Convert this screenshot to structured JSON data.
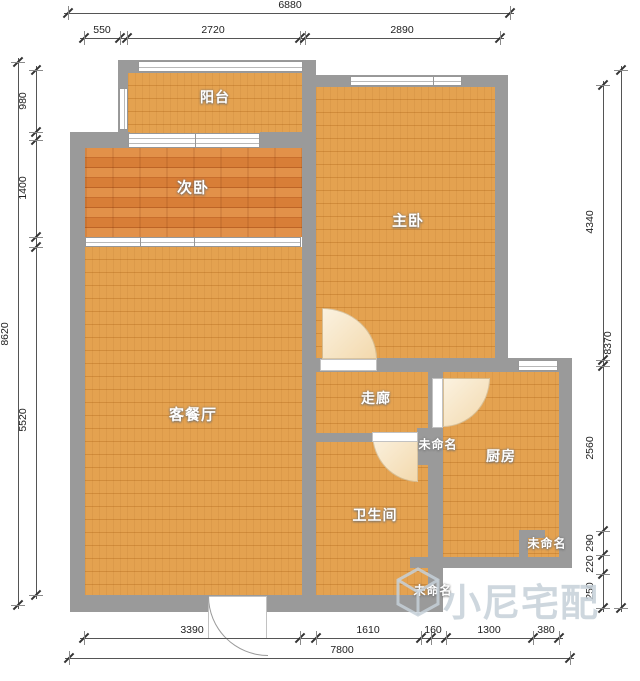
{
  "canvas": {
    "width": 640,
    "height": 681,
    "background": "#ffffff"
  },
  "colors": {
    "wall": "#9a9a9a",
    "floor_base": "#e4a250",
    "floor_seam": "#d18c3b",
    "floor_alt_base": "#d87e37",
    "floor_alt_dark": "#c86e2d",
    "window_fill": "#ffffff",
    "door_swing_fill": "#f6e3bf",
    "dimension_line": "#555555",
    "dimension_text": "#222222",
    "watermark": "#c6d0d8"
  },
  "watermark": {
    "text": "小尼宅配",
    "text_x": 443,
    "text_y": 572,
    "logo": {
      "name": "cube-logo",
      "x": 395,
      "y": 567,
      "w": 46,
      "h": 50
    }
  },
  "rooms": [
    {
      "label": "阳台",
      "x": 215,
      "y": 97,
      "size": 14
    },
    {
      "label": "次卧",
      "x": 193,
      "y": 187,
      "size": 15
    },
    {
      "label": "主卧",
      "x": 408,
      "y": 220,
      "size": 15
    },
    {
      "label": "客餐厅",
      "x": 193,
      "y": 414,
      "size": 15
    },
    {
      "label": "走廊",
      "x": 376,
      "y": 398,
      "size": 14
    },
    {
      "label": "未命名",
      "x": 438,
      "y": 444,
      "size": 12
    },
    {
      "label": "厨房",
      "x": 501,
      "y": 456,
      "size": 14
    },
    {
      "label": "卫生间",
      "x": 375,
      "y": 515,
      "size": 14
    },
    {
      "label": "未命名",
      "x": 547,
      "y": 543,
      "size": 12
    },
    {
      "label": "未命名",
      "x": 433,
      "y": 590,
      "size": 12
    }
  ],
  "plan": {
    "floors": [
      {
        "name": "balcony",
        "style": "floor",
        "x": 128,
        "y": 73,
        "w": 174,
        "h": 60
      },
      {
        "name": "bedroom2",
        "style": "floor-alt",
        "x": 85,
        "y": 148,
        "w": 217,
        "h": 89
      },
      {
        "name": "living",
        "style": "floor",
        "x": 85,
        "y": 247,
        "w": 217,
        "h": 348
      },
      {
        "name": "master",
        "style": "floor",
        "x": 316,
        "y": 87,
        "w": 179,
        "h": 271
      },
      {
        "name": "corridor",
        "style": "floor",
        "x": 316,
        "y": 372,
        "w": 112,
        "h": 61
      },
      {
        "name": "bathroom",
        "style": "floor",
        "x": 316,
        "y": 442,
        "w": 112,
        "h": 153
      },
      {
        "name": "kitchen",
        "style": "floor",
        "x": 443,
        "y": 372,
        "w": 117,
        "h": 185
      }
    ],
    "walls": [
      {
        "x": 118,
        "y": 60,
        "w": 190,
        "h": 13
      },
      {
        "x": 118,
        "y": 60,
        "w": 10,
        "h": 75
      },
      {
        "x": 70,
        "y": 132,
        "w": 60,
        "h": 16
      },
      {
        "x": 260,
        "y": 132,
        "w": 56,
        "h": 16
      },
      {
        "x": 70,
        "y": 132,
        "w": 15,
        "h": 480
      },
      {
        "x": 302,
        "y": 75,
        "w": 206,
        "h": 12
      },
      {
        "x": 302,
        "y": 60,
        "w": 14,
        "h": 552
      },
      {
        "x": 495,
        "y": 75,
        "w": 13,
        "h": 290
      },
      {
        "x": 302,
        "y": 358,
        "w": 270,
        "h": 14
      },
      {
        "x": 559,
        "y": 358,
        "w": 13,
        "h": 210
      },
      {
        "x": 302,
        "y": 433,
        "w": 70,
        "h": 9
      },
      {
        "x": 417,
        "y": 428,
        "w": 15,
        "h": 37
      },
      {
        "x": 428,
        "y": 372,
        "w": 15,
        "h": 196
      },
      {
        "x": 410,
        "y": 557,
        "w": 162,
        "h": 11
      },
      {
        "x": 428,
        "y": 557,
        "w": 15,
        "h": 55
      },
      {
        "x": 70,
        "y": 595,
        "w": 372,
        "h": 17
      },
      {
        "x": 519,
        "y": 530,
        "w": 9,
        "h": 30
      },
      {
        "x": 519,
        "y": 530,
        "w": 26,
        "h": 8
      }
    ],
    "windows": [
      {
        "x": 138,
        "y": 61,
        "w": 165,
        "h": 11,
        "dir": "h",
        "lines": 1,
        "dividers": []
      },
      {
        "x": 119,
        "y": 88,
        "w": 9,
        "h": 42,
        "dir": "v",
        "lines": 1,
        "dividers": []
      },
      {
        "x": 128,
        "y": 133,
        "w": 132,
        "h": 15,
        "dir": "h",
        "lines": 2,
        "dividers": [
          0.5
        ]
      },
      {
        "x": 85,
        "y": 237,
        "w": 216,
        "h": 10,
        "dir": "h",
        "lines": 1,
        "dividers": [
          0.25,
          0.5
        ]
      },
      {
        "x": 350,
        "y": 76,
        "w": 112,
        "h": 10,
        "dir": "h",
        "lines": 1,
        "dividers": [
          0.73
        ]
      },
      {
        "x": 518,
        "y": 360,
        "w": 40,
        "h": 11,
        "dir": "h",
        "lines": 1,
        "dividers": []
      }
    ],
    "thresholds": [
      {
        "x": 320,
        "y": 359,
        "w": 57,
        "h": 12
      },
      {
        "x": 372,
        "y": 432,
        "w": 46,
        "h": 10
      },
      {
        "x": 432,
        "y": 378,
        "w": 11,
        "h": 50
      },
      {
        "x": 208,
        "y": 596,
        "w": 59,
        "h": 43
      }
    ],
    "door_swings": [
      {
        "x": 322,
        "y": 308,
        "w": 55,
        "h": 51,
        "corner": "tr"
      },
      {
        "x": 372,
        "y": 433,
        "w": 46,
        "h": 49,
        "corner": "bl"
      },
      {
        "x": 443,
        "y": 378,
        "w": 47,
        "h": 49,
        "corner": "br"
      }
    ],
    "entry_arc": {
      "x": 208,
      "y": 596,
      "w": 60,
      "h": 60
    }
  },
  "dimensions": [
    {
      "dir": "h",
      "pos": 13,
      "from": 68,
      "to": 510,
      "ticks": [
        68,
        510
      ],
      "labels": [
        {
          "t": "6880",
          "at": 290
        }
      ]
    },
    {
      "dir": "h",
      "pos": 38,
      "from": 84,
      "to": 500,
      "ticks": [
        84,
        120,
        127,
        300,
        305,
        500
      ],
      "labels": [
        {
          "t": "550",
          "at": 102
        },
        {
          "t": "2720",
          "at": 213
        },
        {
          "t": "2890",
          "at": 402
        }
      ]
    },
    {
      "dir": "v",
      "pos": 18,
      "from": 62,
      "to": 605,
      "ticks": [
        62,
        605
      ],
      "labels": [
        {
          "t": "8620",
          "at": 334
        }
      ]
    },
    {
      "dir": "v",
      "pos": 36,
      "from": 70,
      "to": 595,
      "ticks": [
        70,
        132,
        140,
        237,
        247,
        595
      ],
      "labels": [
        {
          "t": "980",
          "at": 101
        },
        {
          "t": "1400",
          "at": 188
        },
        {
          "t": "5520",
          "at": 420
        }
      ]
    },
    {
      "dir": "v",
      "pos": 621,
      "from": 70,
      "to": 608,
      "ticks": [
        70,
        608
      ],
      "labels": [
        {
          "t": "8370",
          "at": 343
        }
      ]
    },
    {
      "dir": "v",
      "pos": 603,
      "from": 85,
      "to": 608,
      "ticks": [
        85,
        360,
        366,
        531,
        555,
        574,
        608
      ],
      "labels": [
        {
          "t": "4340",
          "at": 222
        },
        {
          "t": "2560",
          "at": 448
        },
        {
          "t": "290",
          "at": 543
        },
        {
          "t": "220",
          "at": 564
        },
        {
          "t": "250",
          "at": 591
        }
      ]
    },
    {
      "dir": "h",
      "pos": 638,
      "from": 84,
      "to": 559,
      "ticks": [
        84,
        300,
        316,
        421,
        431,
        446,
        533,
        559
      ],
      "labels": [
        {
          "t": "3390",
          "at": 192
        },
        {
          "t": "1610",
          "at": 368
        },
        {
          "t": "160",
          "at": 433
        },
        {
          "t": "1300",
          "at": 489
        },
        {
          "t": "380",
          "at": 546
        }
      ]
    },
    {
      "dir": "h",
      "pos": 658,
      "from": 69,
      "to": 570,
      "ticks": [
        69,
        570
      ],
      "labels": [
        {
          "t": "7800",
          "at": 342
        }
      ]
    }
  ]
}
